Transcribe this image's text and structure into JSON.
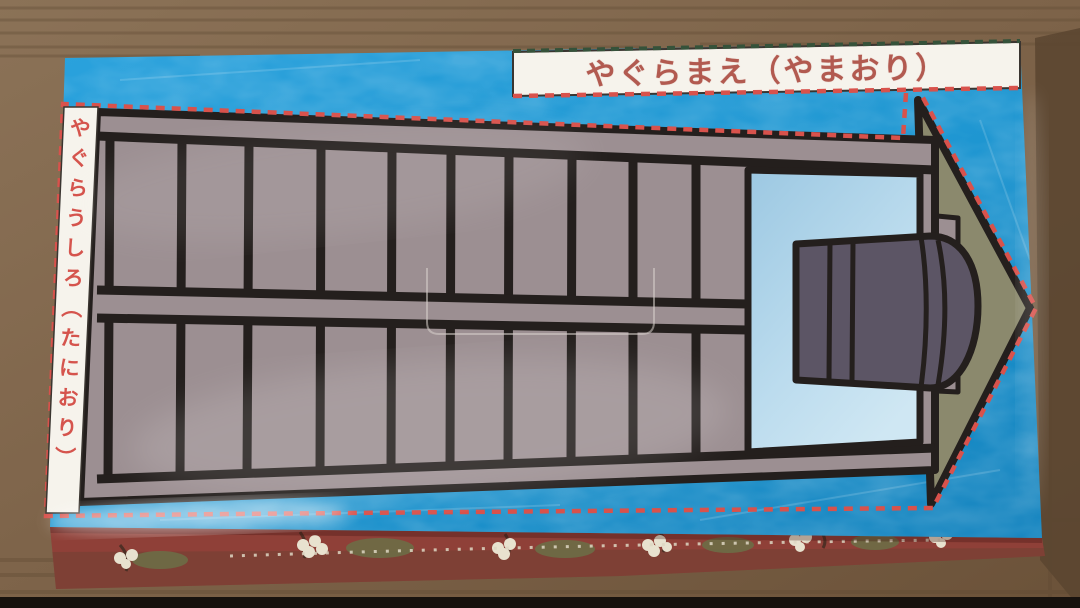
{
  "labels": {
    "top_banner": "やぐらまえ（やまおり）",
    "left_strip": "やぐらうしろ（たにおり）"
  },
  "colors": {
    "table_wood": "#7e644a",
    "table_wood_dark": "#5a4530",
    "box_blue": "#1f97d2",
    "box_side_maroon": "#8f4038",
    "cut_line_red": "#d8524c",
    "fold_line_green": "#35523a",
    "frame_taupe": "#9c8f92",
    "outline_black": "#241f1d",
    "roof_olive": "#8b896d",
    "drum_purple": "#5c5565",
    "window_blue_light": "#cfe7f3",
    "window_blue_dark": "#9cc8e2",
    "banner_bg": "#f6f3ec",
    "banner_text_color": "#b25a50",
    "strip_text_color": "#d5544d"
  }
}
